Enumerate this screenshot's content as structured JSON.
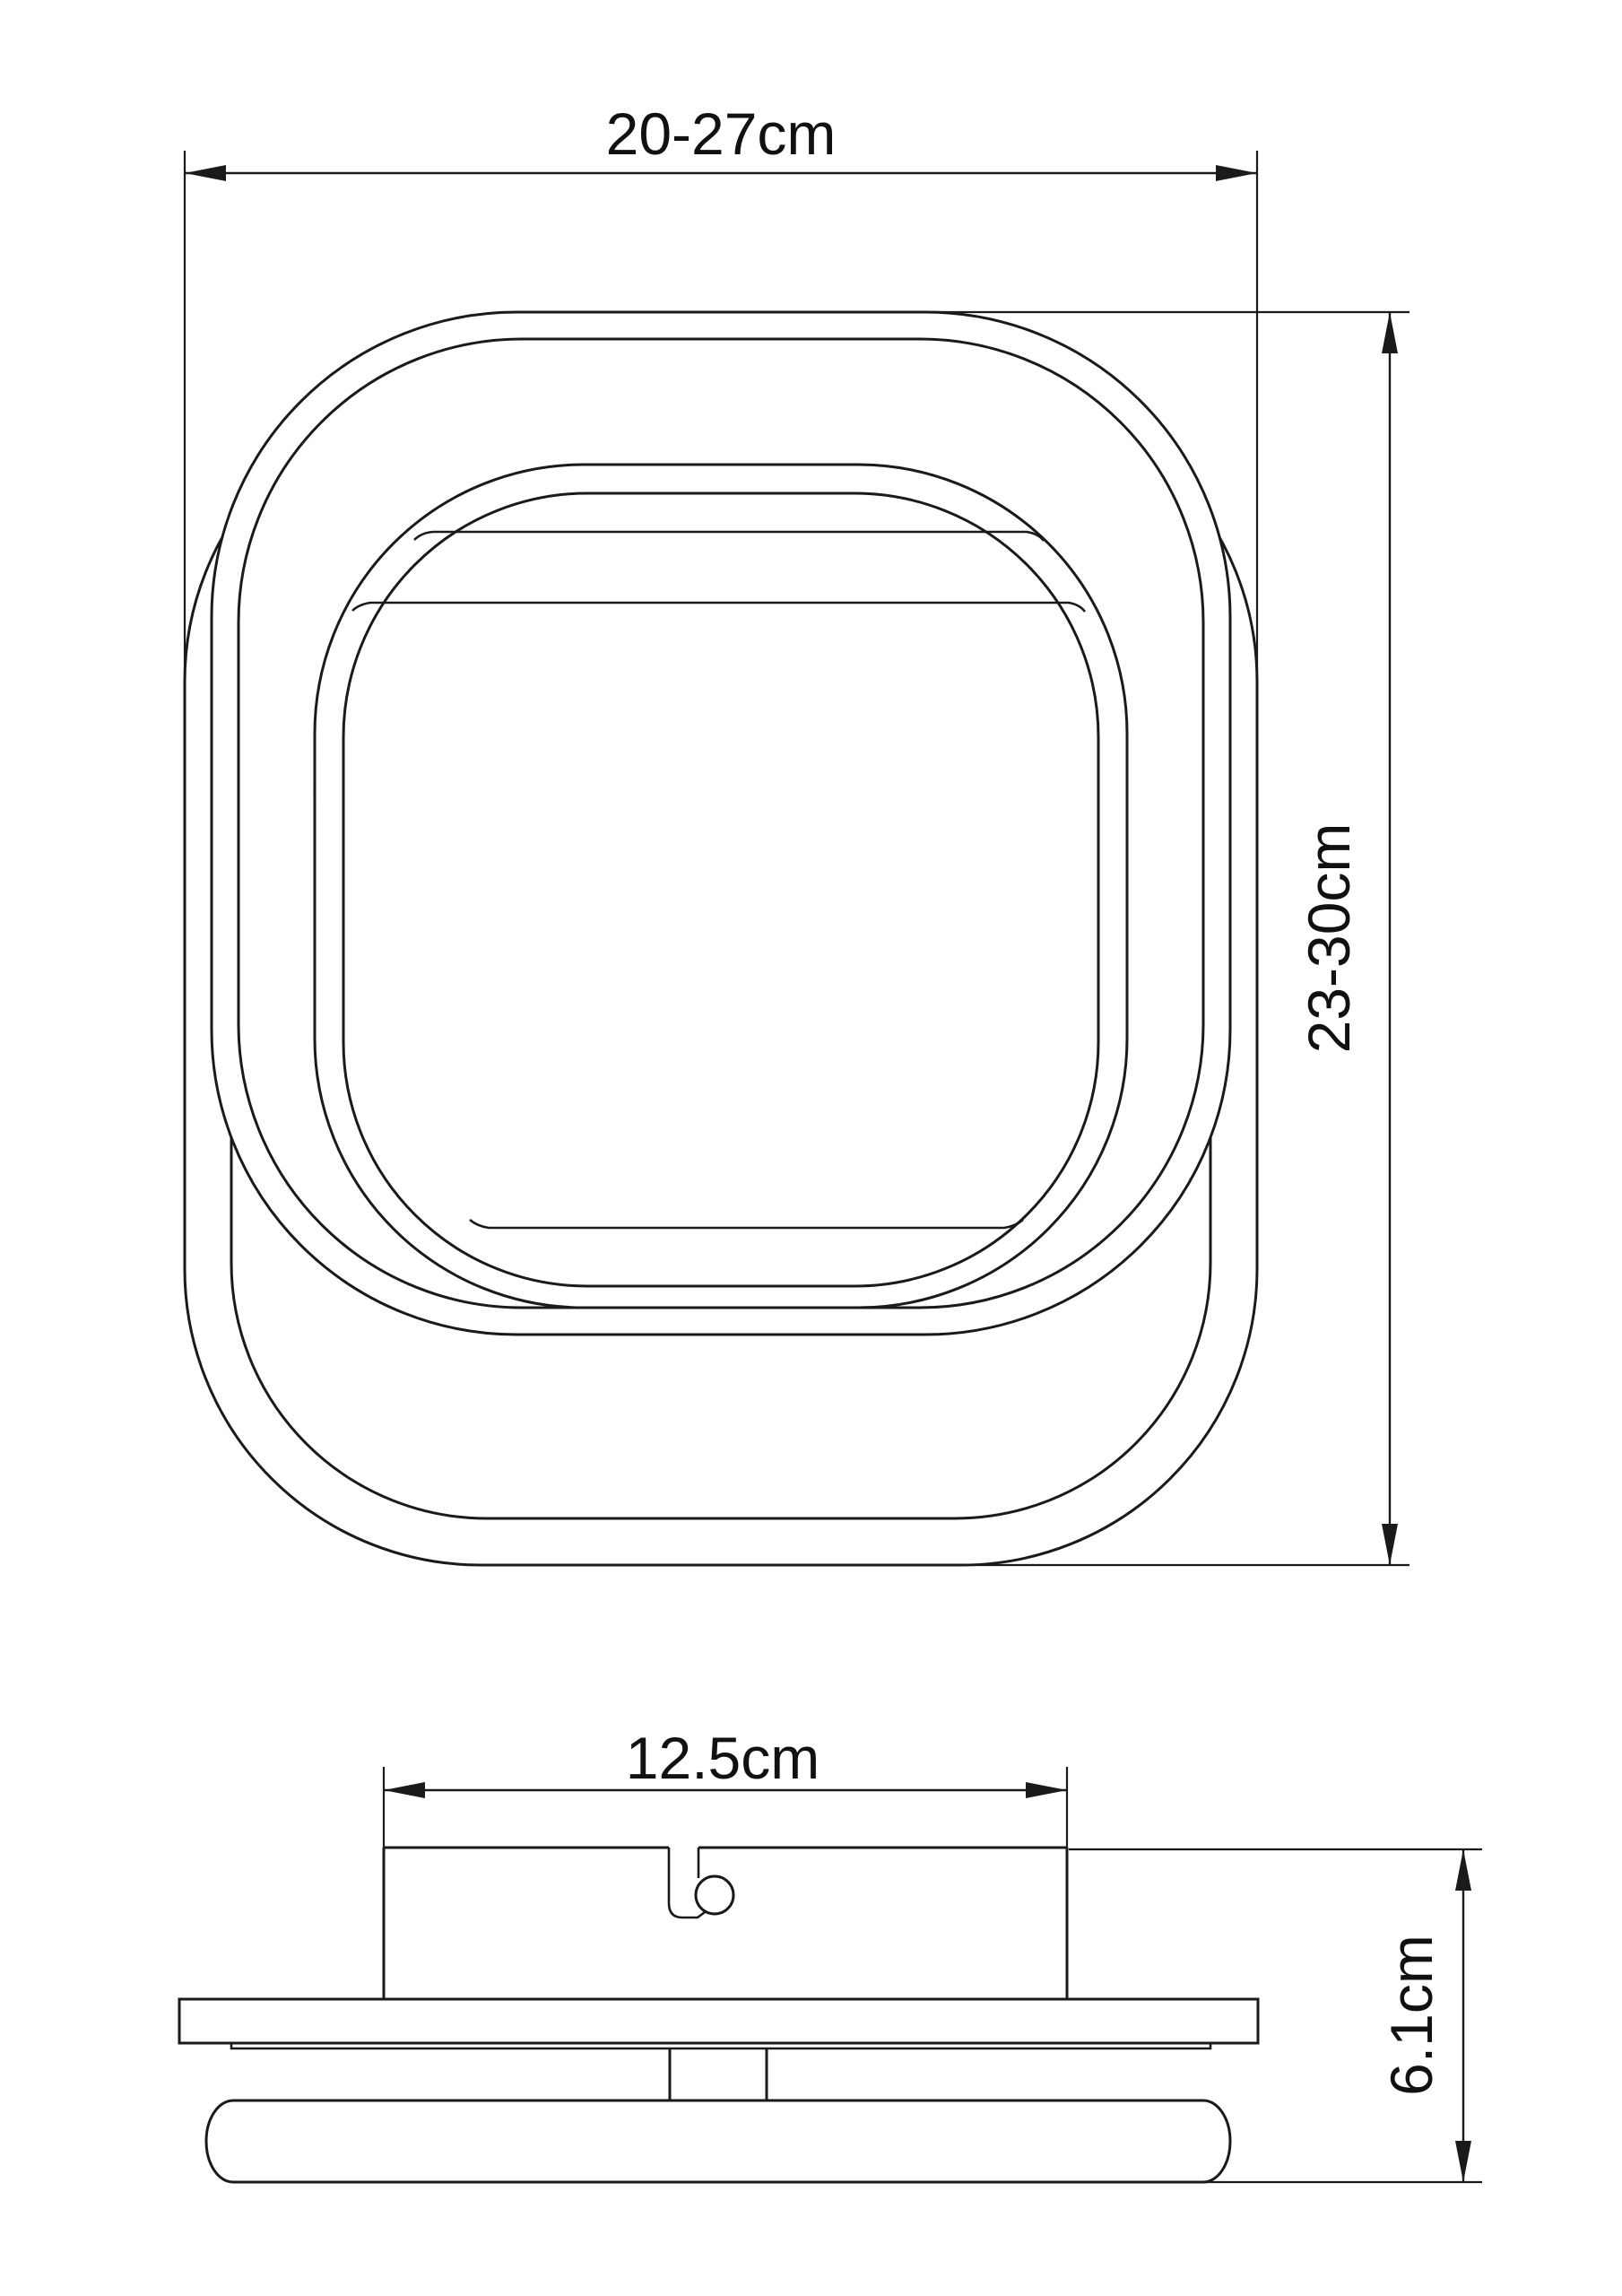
{
  "page": {
    "background_color": "#ffffff",
    "line_color": "#1a1a1a",
    "text_color": "#111111"
  },
  "dimensions": {
    "overall_width_label": "20-27cm",
    "overall_height_label": "23-30cm",
    "bracket_width_label": "12.5cm",
    "profile_height_label": "6.1cm"
  }
}
